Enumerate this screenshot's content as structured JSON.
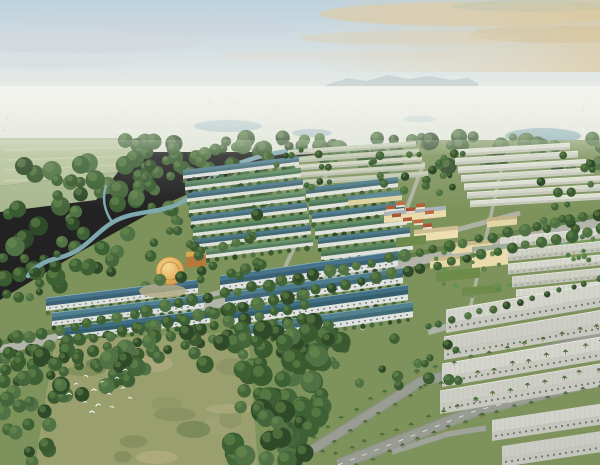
{
  "scene": {
    "viewBox": "0 0 600 465",
    "w": 600,
    "h": 465,
    "label": "aerial-masterplan-rendering"
  },
  "palette": {
    "treeDarks": [
      "#2f4a28",
      "#3a5a30",
      "#45663a",
      "#507244",
      "#3d6135"
    ],
    "treeHighlight": "#6e9050",
    "palmFrond": "#3e6634",
    "palmCore": "#4b7339",
    "trunk": "#7b6b48",
    "ground": "#7e935c",
    "road": "#b3b5ab",
    "roadDark": "#999c92",
    "roadEdge": "#8f938a",
    "verge": "#66814a",
    "water": "#7fa9ae",
    "bird": "#f8f8f3"
  },
  "sky": {
    "clouds": [
      [
        75,
        42,
        130,
        11,
        "#d2d9dd",
        0.8
      ],
      [
        200,
        28,
        100,
        8,
        "#ccd5da",
        0.55
      ],
      [
        40,
        62,
        92,
        7,
        "#d8dee0",
        0.5
      ],
      [
        470,
        14,
        150,
        12,
        "#d8ccb0",
        0.85
      ],
      [
        560,
        34,
        90,
        9,
        "#cfc3a6",
        0.7
      ],
      [
        410,
        38,
        110,
        7,
        "#dbd2bc",
        0.55
      ],
      [
        532,
        6,
        80,
        6,
        "#a7c0b8",
        0.5
      ],
      [
        340,
        56,
        120,
        6,
        "#e2ddd0",
        0.4
      ],
      [
        130,
        20,
        110,
        7,
        "#c9d4da",
        0.45
      ]
    ]
  },
  "distant": {
    "mountain": "M326,85 L348,78 L366,81 L388,75 L408,79 L430,76 L452,80 L468,78 L478,83 L478,87 L326,87 Z",
    "mountainFill": "#b6c2c6",
    "specks": {
      "n": 170,
      "y0": 100,
      "y1": 139,
      "colors": [
        "#f4f4ee",
        "#dadfd2",
        "#c3ccba",
        "#e7e9e0"
      ]
    },
    "lakes": [
      [
        228,
        126,
        34,
        6,
        "#a9c3c5",
        0.9
      ],
      [
        420,
        119,
        16,
        3.5,
        "#b6cac9",
        0.7
      ],
      [
        543,
        136,
        38,
        8,
        "#8fb2b7",
        0.95
      ],
      [
        591,
        151,
        20,
        6,
        "#7fa8ad",
        0.9
      ],
      [
        312,
        133,
        20,
        4,
        "#9fbcbe",
        0.8
      ]
    ]
  },
  "ground": {
    "pts": "0,300 80,252 170,202 260,162 420,140 600,140 600,465 0,465",
    "fill": "#7e935c"
  },
  "fields": {
    "polys": [
      {
        "pts": "0,138 150,138 118,172 0,186",
        "fill": "#b7c39c"
      },
      {
        "pts": "0,186 118,172 96,200 0,212",
        "fill": "#a9b890"
      }
    ],
    "stripes": [
      [
        5,
        150,
        138,
        147
      ],
      [
        5,
        160,
        128,
        156
      ],
      [
        5,
        170,
        118,
        165
      ],
      [
        4,
        181,
        100,
        176
      ]
    ],
    "stripeColor": "#c7d1ad"
  },
  "leftForest": {
    "clusters": [
      {
        "x0": 0,
        "x1": 150,
        "y0": 162,
        "y1": 292,
        "n": 55,
        "r0": 5,
        "r1": 10
      },
      {
        "x0": 130,
        "x1": 272,
        "y0": 148,
        "y1": 216,
        "n": 32,
        "r0": 4,
        "r1": 8
      }
    ]
  },
  "river": {
    "main": "M296,150 C262,154 238,162 220,172 C202,182 196,196 178,204 C158,214 130,210 110,224 C92,236 84,252 58,258 C44,261 34,268 28,276",
    "branch": "M112,222 C104,210 102,198 106,186",
    "w": 4.5,
    "wBranch": 2.5
  },
  "forestBand": {
    "clusters": [
      {
        "x0": 120,
        "x1": 620,
        "y0": 136,
        "y1": 168,
        "n": 85,
        "r0": 4,
        "r1": 9
      }
    ]
  },
  "roads": [
    {
      "pts": [
        [
          0,
          350
        ],
        [
          300,
          286
        ],
        [
          600,
          222
        ]
      ],
      "w": 9,
      "color": "#b3b5ab",
      "verge": 10
    },
    {
      "pts": [
        [
          252,
          342
        ],
        [
          330,
          166
        ]
      ],
      "w": 4,
      "color": "#b6b8ac",
      "o": 0.85
    },
    {
      "pts": [
        [
          362,
          330
        ],
        [
          424,
          162
        ]
      ],
      "w": 4,
      "color": "#b6b8ac",
      "o": 0.85
    },
    {
      "pts": [
        [
          468,
          318
        ],
        [
          502,
          166
        ]
      ],
      "w": 3.5,
      "color": "#b6b8ac",
      "o": 0.85
    },
    {
      "pts": [
        [
          180,
          303
        ],
        [
          520,
          213
        ]
      ],
      "w": 5,
      "color": "#b4b6ac",
      "o": 0.9
    },
    {
      "pts": [
        [
          428,
          332
        ],
        [
          600,
          284
        ]
      ],
      "w": 6.5,
      "color": "#aeb1a6"
    },
    {
      "pts": [
        [
          288,
          465
        ],
        [
          420,
          382
        ],
        [
          600,
          336
        ]
      ],
      "w": 10,
      "color": "#9a9d93",
      "edge": true
    },
    {
      "pts": [
        [
          338,
          465
        ],
        [
          478,
          410
        ],
        [
          600,
          380
        ]
      ],
      "w": 12,
      "color": "#999c92",
      "edge": true,
      "dash": true
    },
    {
      "pts": [
        [
          392,
          452
        ],
        [
          448,
          434
        ],
        [
          486,
          428
        ]
      ],
      "w": 5.5,
      "color": "#a0a399"
    }
  ],
  "treeLines": [
    {
      "road": 0,
      "type": "round",
      "spacing": 15,
      "offset": 8,
      "sides": [
        -1,
        1
      ],
      "r0": 4,
      "r1": 6.5
    },
    {
      "road": 6,
      "type": "palm",
      "spacing": 17,
      "offset": 8,
      "sides": [
        -1,
        1
      ]
    },
    {
      "road": 7,
      "type": "palm",
      "spacing": 16,
      "offset": 9,
      "sides": [
        -1,
        1
      ]
    },
    {
      "road": 5,
      "type": "round",
      "spacing": 13,
      "offset": 5,
      "sides": [
        -1
      ],
      "r0": 2.5,
      "r1": 4
    }
  ],
  "rowGroups": [
    {
      "name": "far-beige",
      "x": 288,
      "y": 150,
      "count": 5,
      "gap": 7.5,
      "dx": 3,
      "len": 128,
      "slope": -0.07,
      "roofH": 3.5,
      "facH": 2,
      "roofs": [
        "#ccd1bc",
        "#c2cbb3",
        "#d3d5c1"
      ],
      "fac": "#b7bdac"
    },
    {
      "name": "far-right-white",
      "x": 452,
      "y": 150,
      "count": 7,
      "gap": 8.5,
      "dx": 3,
      "len": 118,
      "dlen": 5,
      "slope": -0.06,
      "roofH": 4,
      "facH": 2.4,
      "roofs": [
        "#dcded2",
        "#d3d6c8"
      ],
      "fac": "#c5c7ba",
      "ridge": "#eceee6"
    },
    {
      "name": "mid-left",
      "x": 183,
      "y": 170,
      "count": 8,
      "gap": 11.5,
      "dx": 2,
      "len": 116,
      "slope": -0.12,
      "roofH": 5.5,
      "facH": 3.5,
      "roofs": [
        "#54808e",
        "#5c8a63",
        "#4d7887",
        "#67926c"
      ],
      "fac": "#dde1da",
      "shade": "rgba(30,55,65,0.25)",
      "trees": true
    },
    {
      "name": "mid-center",
      "x": 306,
      "y": 188,
      "count": 6,
      "gap": 12.5,
      "dx": 3,
      "len": 92,
      "slope": -0.12,
      "roofH": 6,
      "facH": 4,
      "roofs": [
        "#4e7a89",
        "#5a8760",
        "#53808e",
        "#618e68"
      ],
      "fac": "#dfe3dc",
      "shade": "rgba(30,55,65,0.25)",
      "trees": true
    },
    {
      "name": "right-white-mid",
      "x": 500,
      "y": 238,
      "count": 5,
      "gap": 13,
      "dx": 4,
      "len": 100,
      "slope": -0.1,
      "roofH": 6.5,
      "facH": 4,
      "roofs": [
        "#d8d9cf",
        "#d0d2c7"
      ],
      "fac": "#c1c3b8",
      "ribs": true,
      "ribColor": "#b3b5aa",
      "ridge": "#edeee8",
      "win": true,
      "winColor": "#75776f",
      "winR": 0.7
    },
    {
      "name": "left-teal",
      "x": 46,
      "y": 298,
      "count": 3,
      "gap": 15,
      "dx": 6,
      "len": 152,
      "slope": -0.12,
      "roofH": 8,
      "facH": 5,
      "roofs": [
        "#48758a",
        "#508092",
        "#3f6e82"
      ],
      "fac": "#dce1df",
      "ridge": "#8fb2bd",
      "shade": "rgba(20,45,58,0.28)",
      "win": true,
      "winColor": "#5b5d57",
      "winR": 0.8,
      "trees": true
    },
    {
      "name": "front-teal",
      "x": 220,
      "y": 276,
      "count": 4,
      "gap": 17,
      "dx": 5,
      "len": 178,
      "slope": -0.14,
      "roofH": 9,
      "facH": 6,
      "roofs": [
        "#47748a",
        "#4f7d90",
        "#416f83",
        "#52818f"
      ],
      "fac": "#dde2e0",
      "ridge": "#8fb2bd",
      "shade": "rgba(20,45,58,0.28)",
      "win": true,
      "winColor": "#595b54",
      "winR": 0.9,
      "trees": true
    },
    {
      "name": "front-white",
      "x": 446,
      "y": 310,
      "count": 4,
      "gap": 27,
      "dx": -2,
      "len": 176,
      "slope": -0.17,
      "roofH": 13,
      "facH": 10,
      "roofs": [
        "#d4d5cd",
        "#cdcfc6"
      ],
      "fac": "#c7c8bf",
      "ribs": true,
      "ribColor": "#b9bab1",
      "ridge": "#eff0ea",
      "win": true,
      "winColor": "#67695f",
      "winR": 1.1
    },
    {
      "name": "corner-white",
      "x": 492,
      "y": 420,
      "count": 2,
      "gap": 26,
      "dx": 10,
      "len": 110,
      "slope": -0.15,
      "roofH": 12,
      "facH": 9,
      "roofs": [
        "#d2d3cb",
        "#cbccc4"
      ],
      "fac": "#c4c5bc",
      "ribs": true,
      "ribColor": "#b7b8af",
      "win": true,
      "winColor": "#67695f",
      "winR": 1.1
    }
  ],
  "campus": {
    "blocks": [
      {
        "x": 348,
        "y": 196,
        "len": 54,
        "slope": -0.1,
        "roofH": 4.5,
        "facH": 5,
        "roof": "#5a8792",
        "fac": "#ded2a0"
      },
      {
        "x": 384,
        "y": 212,
        "len": 62,
        "slope": -0.1,
        "roofH": 4,
        "facH": 7,
        "roof": "#a9b3ba",
        "fac": "#e9dbab"
      },
      {
        "x": 414,
        "y": 230,
        "len": 44,
        "slope": -0.1,
        "roofH": 4,
        "facH": 8,
        "roof": "#cdbf93",
        "fac": "#eddfb0"
      },
      {
        "x": 452,
        "y": 243,
        "len": 40,
        "slope": -0.1,
        "roofH": 4,
        "facH": 7,
        "roof": "#c6b88c",
        "fac": "#e7d8a8"
      },
      {
        "x": 487,
        "y": 218,
        "len": 30,
        "slope": -0.1,
        "roofH": 3.5,
        "facH": 6,
        "roof": "#c2b488",
        "fac": "#e4d5a5"
      },
      {
        "x": 472,
        "y": 247,
        "len": 36,
        "slope": -0.1,
        "roofH": 5,
        "facH": 16,
        "roof": "#9fae9a",
        "fac": "#eadcad"
      },
      {
        "x": 430,
        "y": 258,
        "len": 30,
        "slope": -0.1,
        "roofH": 3.5,
        "facH": 7,
        "roof": "#c9bb8e",
        "fac": "#e6d7a7"
      }
    ],
    "courts": [
      {
        "x": 396,
        "y": 238,
        "len": 30,
        "h": 9
      },
      {
        "x": 436,
        "y": 272,
        "len": 44,
        "h": 10
      },
      {
        "x": 462,
        "y": 288,
        "len": 40,
        "h": 8
      }
    ],
    "courtFill": "#6e8b4a"
  },
  "villas": {
    "items": [
      [
        386,
        206
      ],
      [
        396,
        202
      ],
      [
        406,
        208
      ],
      [
        416,
        204
      ],
      [
        425,
        211
      ],
      [
        392,
        214
      ],
      [
        403,
        218
      ],
      [
        414,
        220
      ],
      [
        423,
        224
      ]
    ],
    "len": 9,
    "slope": -0.1,
    "roofH": 3.5,
    "facH": 2,
    "roofs": [
      "#b25c37",
      "#c06a3e",
      "#a85534"
    ],
    "fac": "#e9e1cd"
  },
  "clubhouse": {
    "cx": 170,
    "cy": 271,
    "r": 14,
    "ringR": 9,
    "ringColor": "#b5823b",
    "plaza": {
      "cx": 163,
      "cy": 291,
      "rx": 24,
      "ry": 7,
      "fill": "#b3ab86"
    },
    "annex": {
      "x": 186,
      "y": 252,
      "len": 20,
      "slope": -0.1,
      "roofH": 5,
      "facH": 11,
      "roof": "#d8a851",
      "fac": "#b5793c"
    }
  },
  "park": {
    "pts": "554,238 600,228 600,266 566,264",
    "fill": "#7c9a57",
    "canal": "M556,234 C566,244 572,254 568,266",
    "canalW": 3
  },
  "clusters": [
    {
      "x0": 150,
      "x1": 262,
      "y0": 205,
      "y1": 282,
      "n": 26,
      "r0": 3.5,
      "r1": 6
    },
    {
      "x0": 368,
      "x1": 470,
      "y0": 150,
      "y1": 194,
      "n": 22,
      "r0": 2.5,
      "r1": 4.5
    },
    {
      "x0": 540,
      "x1": 598,
      "y0": 150,
      "y1": 232,
      "n": 15,
      "r0": 3,
      "r1": 5
    },
    {
      "x0": 300,
      "x1": 460,
      "y0": 338,
      "y1": 392,
      "n": 20,
      "r0": 3,
      "r1": 6
    },
    {
      "x0": 0,
      "x1": 58,
      "y0": 252,
      "y1": 298,
      "n": 10,
      "r0": 3,
      "r1": 5.5
    },
    {
      "x0": 558,
      "x1": 596,
      "y0": 233,
      "y1": 262,
      "n": 8,
      "r0": 2,
      "r1": 3.2,
      "colors": [
        "#4d7340",
        "#5b824a"
      ]
    },
    {
      "x0": 428,
      "x1": 512,
      "y0": 252,
      "y1": 296,
      "n": 16,
      "r0": 1.8,
      "r1": 3,
      "colors": [
        "#5b824a",
        "#679256"
      ]
    },
    {
      "x0": 262,
      "x1": 330,
      "y0": 150,
      "y1": 188,
      "n": 12,
      "r0": 2.5,
      "r1": 4
    }
  ],
  "grove": {
    "clearing": {
      "pts": "55,340 248,332 258,465 35,465",
      "fill": "#99a06d",
      "patches": {
        "n": 14,
        "colors": [
          "#8a9362",
          "#a3a476",
          "#7e8a59",
          "#b0ac7f",
          "#6f7f52"
        ],
        "x0": 60,
        "x1": 240,
        "y0": 345,
        "y1": 460
      }
    },
    "orchard": {
      "x0": 4,
      "x1": 318,
      "lineY0": 358,
      "lineSlope": -0.213,
      "rows": 3,
      "rowGap": 13,
      "spacing": 15,
      "r0": 4.5,
      "r1": 7
    },
    "clusters": [
      {
        "x0": 232,
        "x1": 348,
        "y0": 336,
        "y1": 462,
        "n": 78,
        "r0": 6,
        "r1": 12,
        "slant": {
          "x0": 350,
          "y0": 336,
          "k": 0.38
        }
      },
      {
        "x0": 0,
        "x1": 72,
        "y0": 330,
        "y1": 462,
        "n": 22,
        "r0": 5,
        "r1": 9
      },
      {
        "x0": 0,
        "x1": 332,
        "lineY0": 372,
        "lineSlope": -0.213,
        "band": 40,
        "n": 48,
        "r0": 5,
        "r1": 10,
        "slant": {
          "x0": 350,
          "y0": 336,
          "k": 0.38
        }
      }
    ]
  },
  "birds": {
    "pts": [
      [
        76,
        384,
        -10
      ],
      [
        86,
        376,
        15
      ],
      [
        94,
        390,
        0
      ],
      [
        102,
        382,
        -18
      ],
      [
        109,
        394,
        8
      ],
      [
        117,
        378,
        0
      ],
      [
        123,
        388,
        -12
      ],
      [
        130,
        398,
        10
      ],
      [
        85,
        402,
        0
      ],
      [
        98,
        405,
        -15
      ],
      [
        112,
        407,
        12
      ],
      [
        69,
        394,
        0
      ],
      [
        125,
        370,
        -8
      ],
      [
        92,
        412,
        6
      ]
    ]
  }
}
